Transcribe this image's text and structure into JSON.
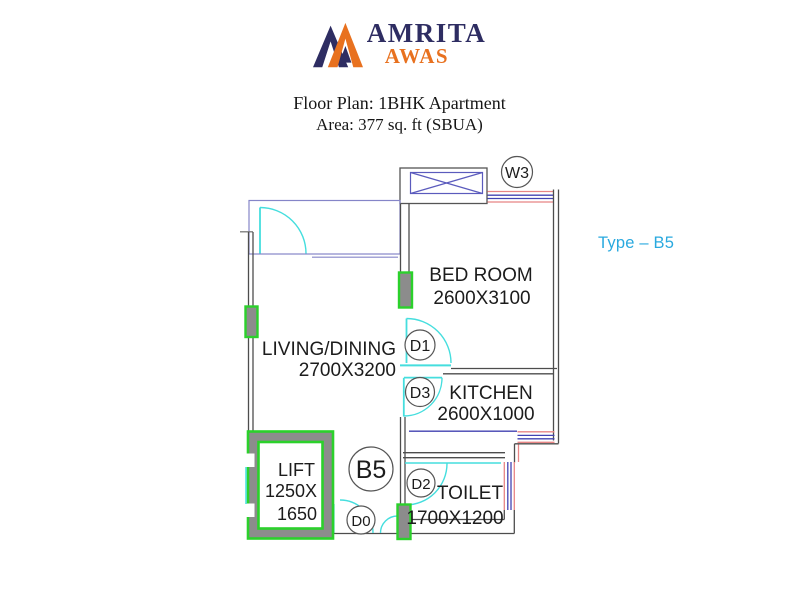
{
  "logo": {
    "brand_top": "AMRITA",
    "brand_bottom": "AWAS",
    "navy": "#2e2d62",
    "orange": "#e8711f"
  },
  "header": {
    "title": "Floor Plan: 1BHK Apartment",
    "subtitle": "Area: 377 sq. ft (SBUA)"
  },
  "plan": {
    "type_label": "Type – B5",
    "unit_label": "B5",
    "rooms": {
      "bedroom": {
        "name": "BED ROOM",
        "dims": "2600X3100"
      },
      "living": {
        "name": "LIVING/DINING",
        "dims": "2700X3200"
      },
      "kitchen": {
        "name": "KITCHEN",
        "dims": "2600X1000"
      },
      "toilet": {
        "name": "TOILET",
        "dims": "1700X1200"
      },
      "lift": {
        "name": "LIFT",
        "dims1": "1250X",
        "dims2": "1650"
      }
    },
    "markers": {
      "w3": "W3",
      "d1": "D1",
      "d3": "D3",
      "d2": "D2",
      "d0": "D0"
    },
    "colors": {
      "wall": "#4d4d4d",
      "door_cyan": "#45dede",
      "window_red": "#e88585",
      "window_blue": "#4343b2",
      "balcony_blue": "#8585c8",
      "column_green": "#2bd12b",
      "fill_gray": "#8c8c8c",
      "type_text": "#29a9df"
    }
  }
}
